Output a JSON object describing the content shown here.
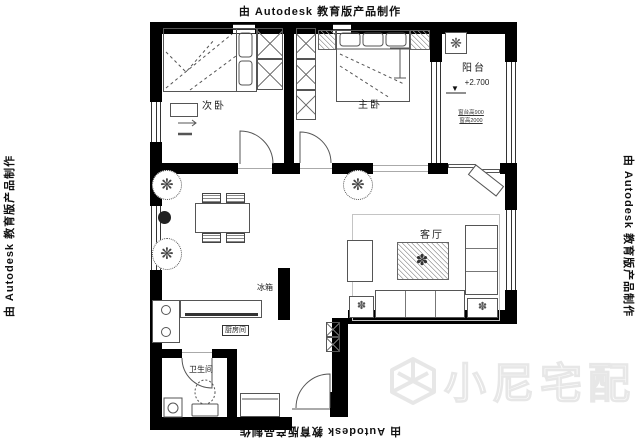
{
  "watermarks": {
    "autodesk_text": "由 Autodesk 教育版产品制作",
    "logo_text": "小尼宅配",
    "logo_color": "#e7e7e7"
  },
  "rooms": {
    "bedroom2": {
      "label": "次卧"
    },
    "master_bedroom": {
      "label": "主卧"
    },
    "balcony": {
      "label": "阳台",
      "elevation": "+2.700",
      "note1": "窗台高900",
      "note2": "窗高2000"
    },
    "living_room": {
      "label": "客厅"
    },
    "kitchen": {
      "label": "厨房间"
    },
    "bathroom": {
      "label": "卫生间"
    },
    "fridge": {
      "label": "冰箱"
    }
  },
  "icons": {
    "plant": "❋",
    "flower": "✽",
    "elevation_triangle": "▼"
  },
  "colors": {
    "wall": "#000000",
    "furniture_line": "#555555",
    "hatch_line": "#999999"
  }
}
